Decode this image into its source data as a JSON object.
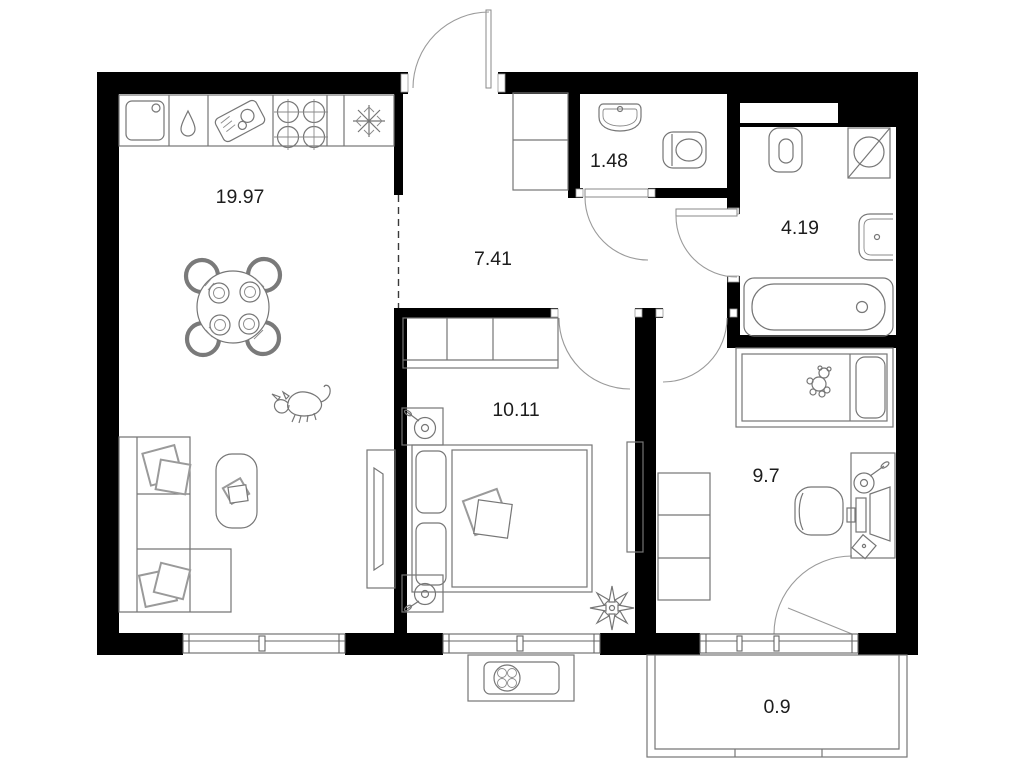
{
  "canvas": {
    "width": 1018,
    "height": 768,
    "background": "#ffffff",
    "wall_color": "#000000",
    "furniture_line_color": "#767676",
    "door_arc_color": "#9a9a9a",
    "label_color": "#1d1d1d"
  },
  "rooms": {
    "kitchen_living": {
      "area": "19.97"
    },
    "hallway": {
      "area": "7.41"
    },
    "wc": {
      "area": "1.48"
    },
    "bathroom": {
      "area": "4.19"
    },
    "bedroom": {
      "area": "10.11"
    },
    "kids_room": {
      "area": "9.7"
    },
    "balcony": {
      "area": "0.9"
    }
  },
  "icons": [
    "kitchen-sink-icon",
    "dishwasher-drop-icon",
    "cutting-board-icon",
    "stove-icon",
    "fridge-snowflake-icon",
    "dining-table-icon",
    "dog-icon",
    "sofa-icon",
    "coffee-table-icon",
    "tv-stand-icon",
    "wardrobe-icon",
    "double-bed-icon",
    "nightstand-lamp-icon",
    "plant-icon",
    "wc-sink-icon",
    "toilet-icon",
    "washing-machine-icon",
    "bath-sink-icon",
    "bathtub-icon",
    "child-bed-icon",
    "teddy-bear-icon",
    "desk-icon",
    "desk-lamp-icon",
    "monitor-icon",
    "office-chair-icon",
    "air-conditioner-icon",
    "window-icon",
    "door-arc-icon",
    "balcony-railing-icon"
  ]
}
